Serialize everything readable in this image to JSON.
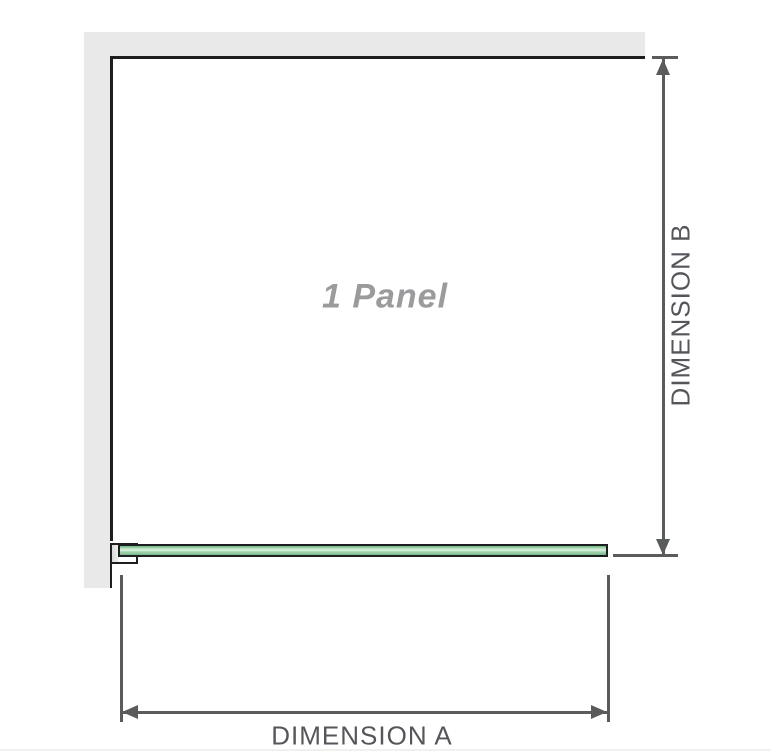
{
  "diagram": {
    "panel_label": "1 Panel",
    "dimension_a": {
      "label": "DIMENSION A"
    },
    "dimension_b": {
      "label": "DIMENSION B"
    }
  },
  "colors": {
    "line-gray": "#5a5b5d",
    "text-gray": "#55565a",
    "wall-gray": "#e9e9ea",
    "outline-black": "#1d1e20",
    "label-gray": "#9b9b9d",
    "glass-green": "#a6d8b2",
    "glass-green-dark": "#79b48a",
    "glass-highlight": "#ddf0e3"
  }
}
